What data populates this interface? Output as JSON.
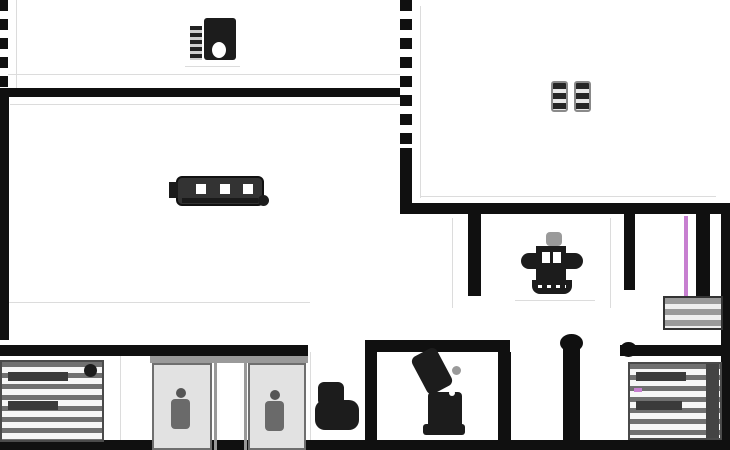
{
  "meta": {
    "kind": "architectural-floor-plan",
    "description": "Low-resolution black and white apartment floor plan with furniture symbols"
  },
  "palette": {
    "background": "#ffffff",
    "wall": "#101010",
    "furniture_dark": "#1c1c1c",
    "furniture_gray": "#707070",
    "stripe_light": "#f6f6f6",
    "hairline": "#dcdcdc",
    "accent_pink": "#c77fd0"
  },
  "regions": [
    {
      "id": "room-top-left",
      "furniture": [
        "sewing-machine-icon"
      ]
    },
    {
      "id": "room-mid-left",
      "furniture": [
        "stove-icon"
      ]
    },
    {
      "id": "room-top-right",
      "furniture": [
        "stool-icon",
        "stool-icon"
      ]
    },
    {
      "id": "hall-right",
      "furniture": [
        "sink-icon",
        "shelf-icon"
      ]
    },
    {
      "id": "rooms-bottom",
      "furniture": [
        "bed-icon",
        "wardrobe-mirror-icon",
        "toilet-icon",
        "armchair-icon",
        "bed-icon"
      ]
    }
  ]
}
